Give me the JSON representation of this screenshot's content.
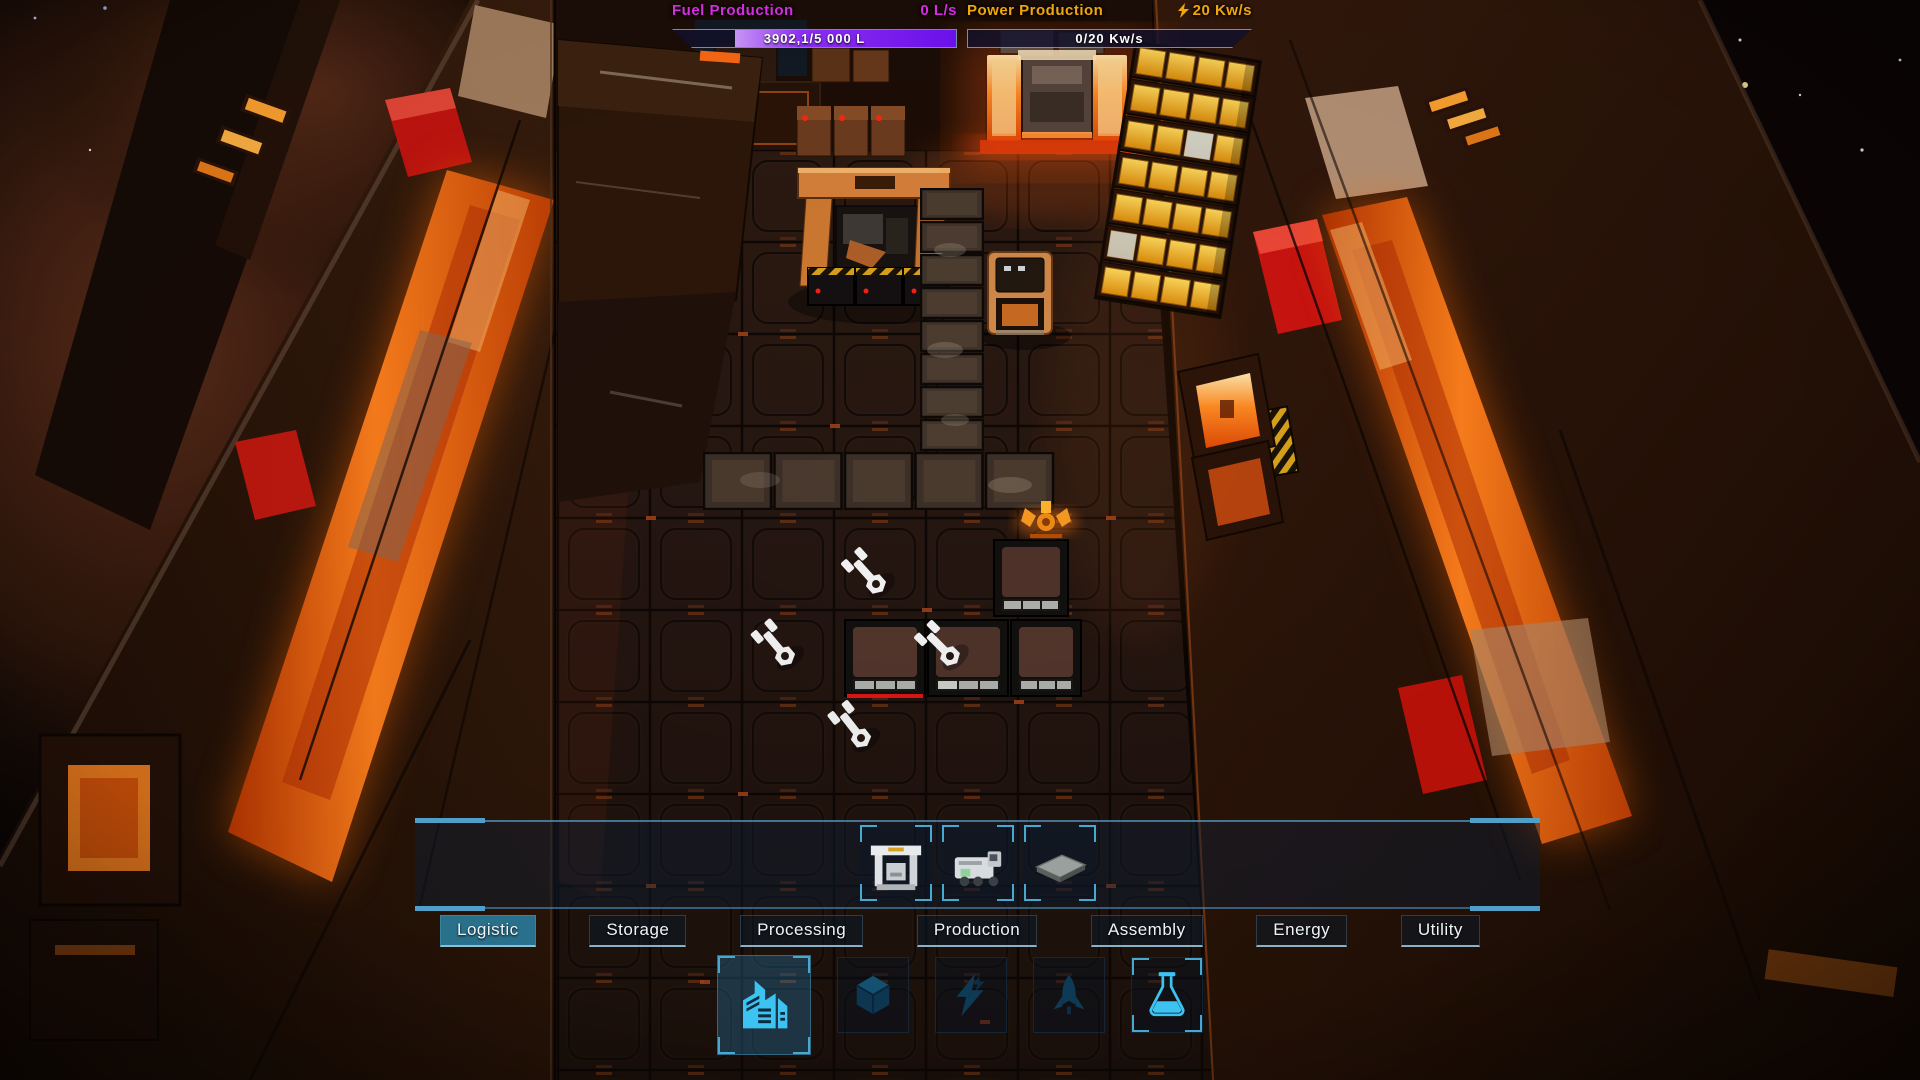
{
  "hud": {
    "fuel": {
      "label": "Fuel Production",
      "rate": "0 L/s",
      "bar_text": "3902,1/5 000 L",
      "fill_percent": 78,
      "label_color": "#d62ce4",
      "fill_start": "#c795f4",
      "fill_end": "#6a10ea"
    },
    "power": {
      "label": "Power Production",
      "rate": "20 Kw/s",
      "bar_text": "0/20 Kw/s",
      "fill_percent": 0,
      "label_color": "#f0a70d",
      "rate_icon": "lightning-icon"
    }
  },
  "build_menu": {
    "slots": [
      {
        "icon": "crane-module-icon"
      },
      {
        "icon": "hauler-module-icon"
      },
      {
        "icon": "platform-module-icon"
      }
    ],
    "tabs": [
      {
        "label": "Logistic",
        "active": true
      },
      {
        "label": "Storage",
        "active": false
      },
      {
        "label": "Processing",
        "active": false
      },
      {
        "label": "Production",
        "active": false
      },
      {
        "label": "Assembly",
        "active": false
      },
      {
        "label": "Energy",
        "active": false
      },
      {
        "label": "Utility",
        "active": false
      }
    ],
    "categories": [
      {
        "icon": "factory-icon",
        "active": true
      },
      {
        "icon": "cube-icon",
        "active": false
      },
      {
        "icon": "lightning-icon",
        "active": false
      },
      {
        "icon": "rocket-icon",
        "active": false
      },
      {
        "icon": "flask-icon",
        "active": false
      }
    ],
    "colors": {
      "accent_cyan": "#3cc3f2",
      "dim_icon": "#0e3a57",
      "tab_active_bg": "#2a7d9e",
      "bracket": "#47a8d0"
    }
  }
}
